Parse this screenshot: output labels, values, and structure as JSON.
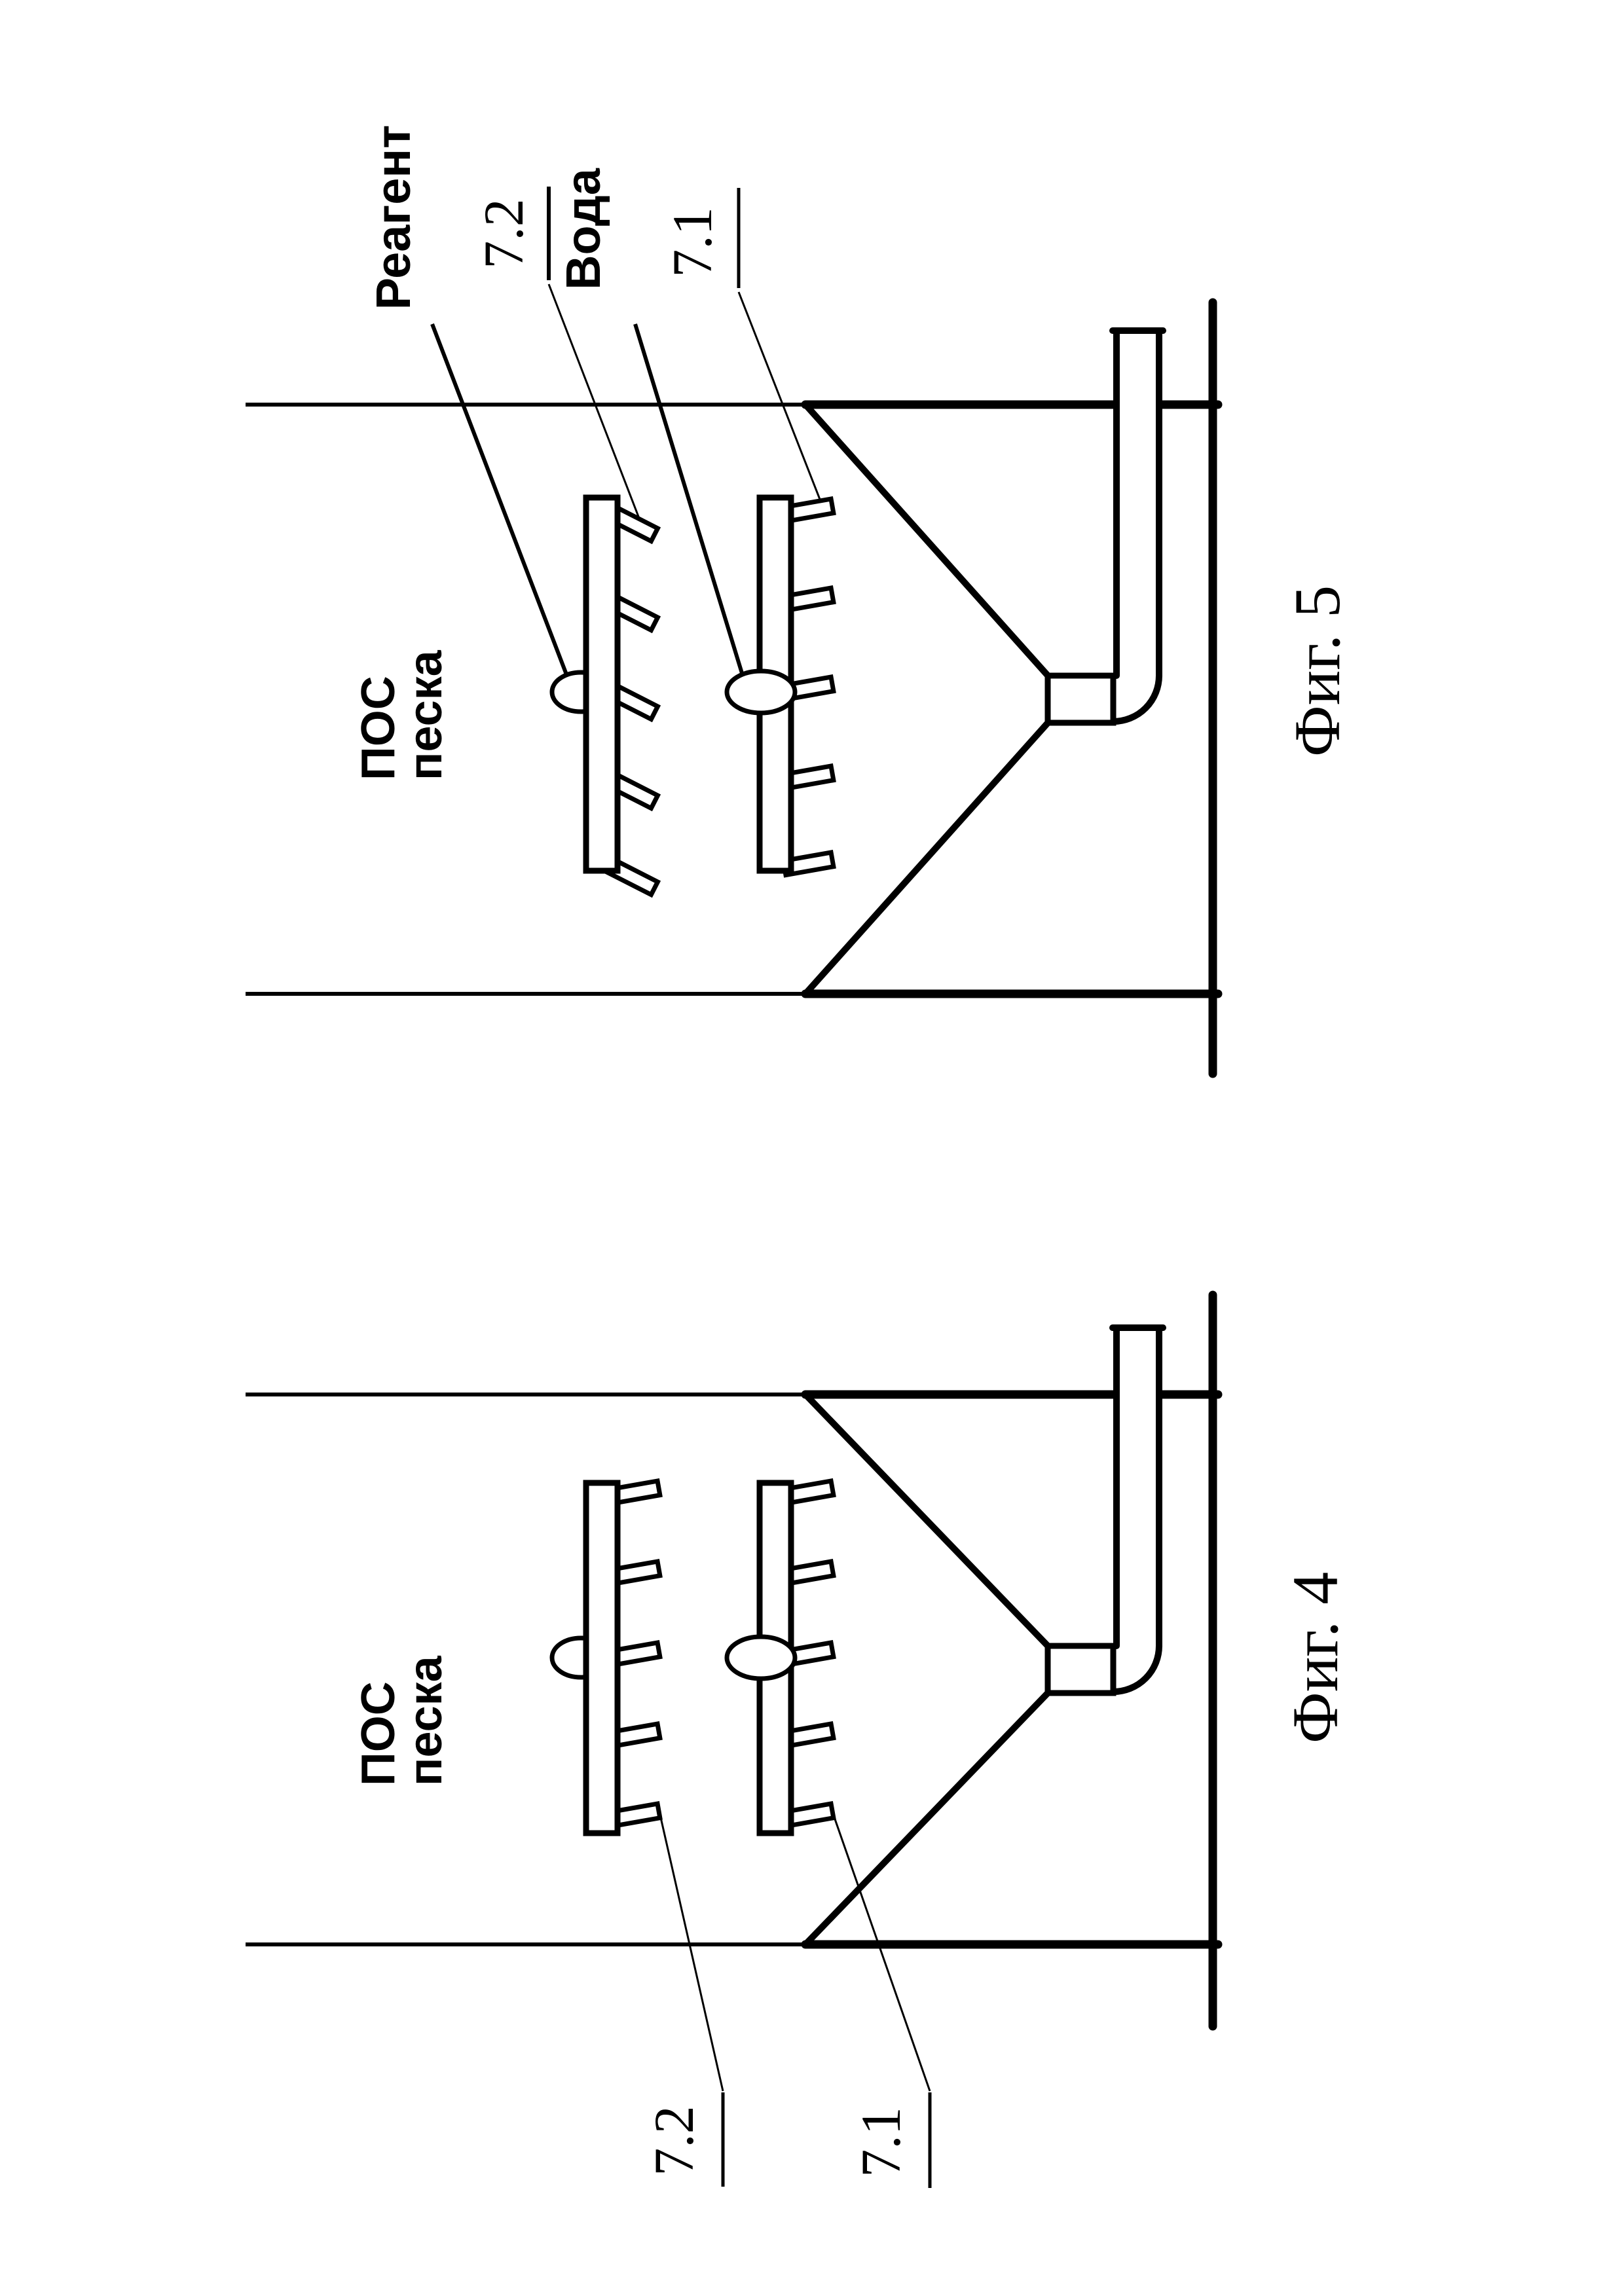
{
  "page": {
    "type": "patent-drawing-scan",
    "orientation": "landscape figures rotated 90deg CCW on portrait page",
    "colors": {
      "ink": "#000000",
      "paper": "#ffffff"
    }
  },
  "figure5": {
    "caption": "Фиг. 5",
    "reagent_label": "Реагент",
    "water_label": "Вода",
    "ref_72": "7.2",
    "ref_71": "7.1",
    "tank_text_line1": "ПОС",
    "tank_text_line2": "песка"
  },
  "figure4": {
    "caption": "Фиг. 4",
    "ref_72": "7.2",
    "ref_71": "7.1",
    "tank_text_line1": "ПОС",
    "tank_text_line2": "песка"
  }
}
